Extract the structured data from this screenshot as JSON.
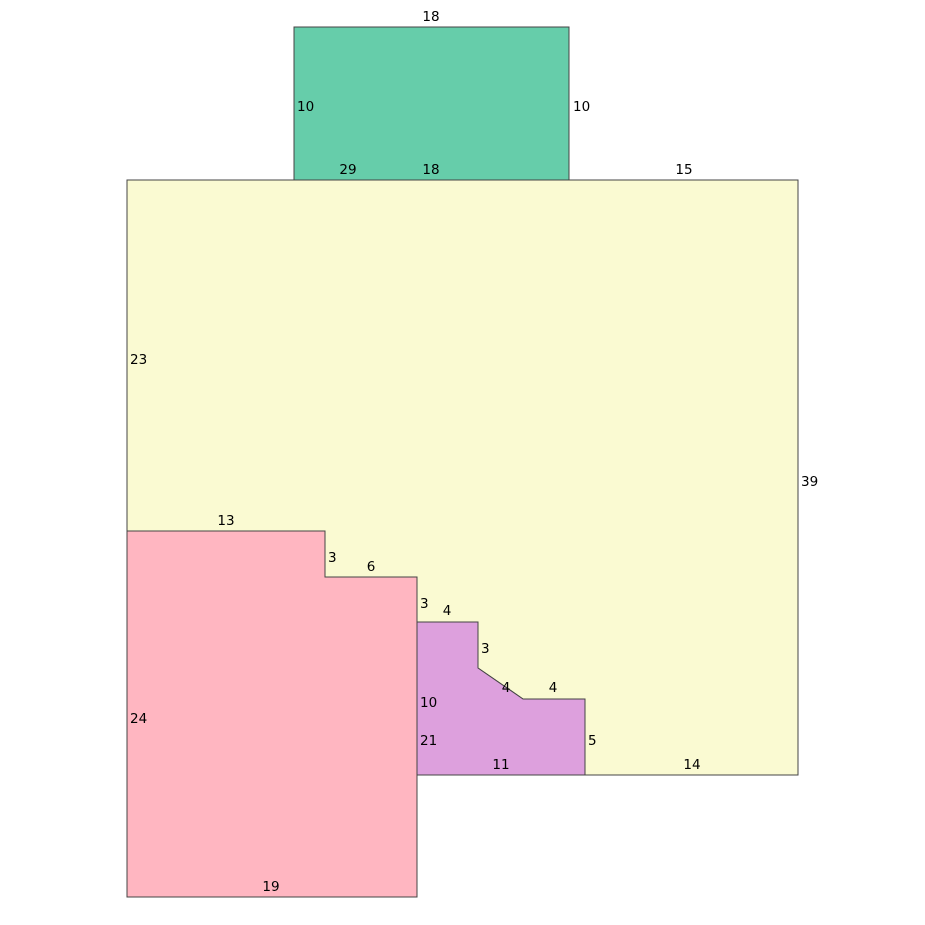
{
  "figure": {
    "width": 925,
    "height": 925,
    "background": "#ffffff",
    "stroke_color": "#444444",
    "stroke_width": 1,
    "label_color": "#000000",
    "font_size": 13.5
  },
  "shapes": [
    {
      "name": "green-rectangle",
      "fill": "#66CDAA",
      "points": [
        [
          294,
          27
        ],
        [
          569,
          27
        ],
        [
          569,
          180
        ],
        [
          294,
          180
        ]
      ]
    },
    {
      "name": "yellow-polygon",
      "fill": "#FAFAD2",
      "points": [
        [
          127,
          180
        ],
        [
          798,
          180
        ],
        [
          798,
          775
        ],
        [
          585,
          775
        ],
        [
          585,
          699
        ],
        [
          523,
          699
        ],
        [
          478,
          668
        ],
        [
          478,
          622
        ],
        [
          417,
          622
        ],
        [
          417,
          577
        ],
        [
          325,
          577
        ],
        [
          325,
          531
        ],
        [
          127,
          531
        ]
      ]
    },
    {
      "name": "pink-polygon",
      "fill": "#FFB6C1",
      "points": [
        [
          127,
          531
        ],
        [
          325,
          531
        ],
        [
          325,
          577
        ],
        [
          417,
          577
        ],
        [
          417,
          897
        ],
        [
          127,
          897
        ]
      ]
    },
    {
      "name": "purple-polygon",
      "fill": "#DDA0DD",
      "points": [
        [
          417,
          622
        ],
        [
          478,
          622
        ],
        [
          478,
          668
        ],
        [
          523,
          699
        ],
        [
          585,
          699
        ],
        [
          585,
          775
        ],
        [
          417,
          775
        ]
      ]
    }
  ],
  "labels": [
    {
      "text": "18",
      "x": 431,
      "y": 17,
      "anchor": "middle"
    },
    {
      "text": "10",
      "x": 297,
      "y": 107,
      "anchor": "start"
    },
    {
      "text": "10",
      "x": 573,
      "y": 107,
      "anchor": "start"
    },
    {
      "text": "29",
      "x": 348,
      "y": 170,
      "anchor": "middle"
    },
    {
      "text": "18",
      "x": 431,
      "y": 170,
      "anchor": "middle"
    },
    {
      "text": "15",
      "x": 684,
      "y": 170,
      "anchor": "middle"
    },
    {
      "text": "23",
      "x": 130,
      "y": 360,
      "anchor": "start"
    },
    {
      "text": "39",
      "x": 801,
      "y": 482,
      "anchor": "start"
    },
    {
      "text": "13",
      "x": 226,
      "y": 521,
      "anchor": "middle"
    },
    {
      "text": "3",
      "x": 328,
      "y": 558,
      "anchor": "start"
    },
    {
      "text": "6",
      "x": 371,
      "y": 567,
      "anchor": "middle"
    },
    {
      "text": "3",
      "x": 420,
      "y": 604,
      "anchor": "start"
    },
    {
      "text": "4",
      "x": 447,
      "y": 611,
      "anchor": "middle"
    },
    {
      "text": "3",
      "x": 481,
      "y": 649,
      "anchor": "start"
    },
    {
      "text": "4",
      "x": 506,
      "y": 688,
      "anchor": "middle"
    },
    {
      "text": "4",
      "x": 553,
      "y": 688,
      "anchor": "middle"
    },
    {
      "text": "10",
      "x": 420,
      "y": 703,
      "anchor": "start"
    },
    {
      "text": "21",
      "x": 420,
      "y": 741,
      "anchor": "start"
    },
    {
      "text": "11",
      "x": 501,
      "y": 765,
      "anchor": "middle"
    },
    {
      "text": "5",
      "x": 588,
      "y": 741,
      "anchor": "start"
    },
    {
      "text": "14",
      "x": 692,
      "y": 765,
      "anchor": "middle"
    },
    {
      "text": "24",
      "x": 130,
      "y": 719,
      "anchor": "start"
    },
    {
      "text": "19",
      "x": 271,
      "y": 887,
      "anchor": "middle"
    }
  ]
}
